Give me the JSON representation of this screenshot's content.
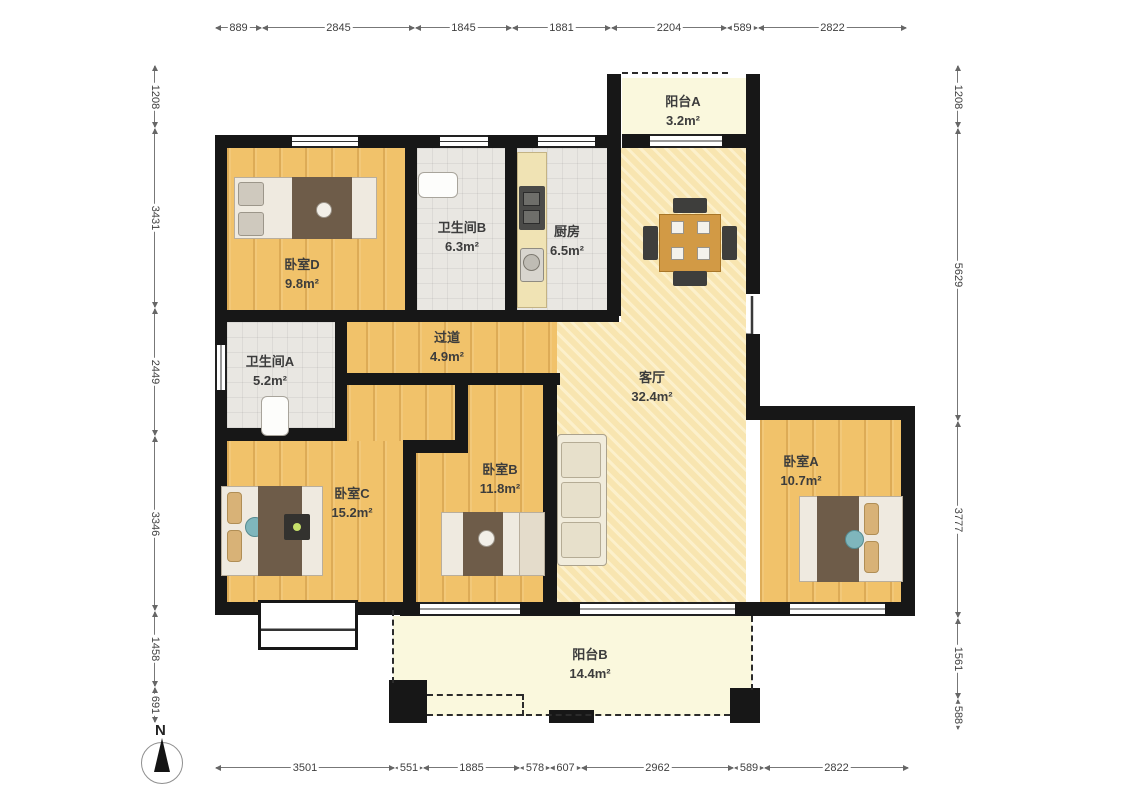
{
  "compass": {
    "label": "N"
  },
  "rooms": [
    {
      "id": "balcony-a",
      "name": "阳台A",
      "area": "3.2m²",
      "cx": 683,
      "cy": 92
    },
    {
      "id": "bedroom-d",
      "name": "卧室D",
      "area": "9.8m²",
      "cx": 302,
      "cy": 255
    },
    {
      "id": "bathroom-b",
      "name": "卫生间B",
      "area": "6.3m²",
      "cx": 462,
      "cy": 218
    },
    {
      "id": "kitchen",
      "name": "厨房",
      "area": "6.5m²",
      "cx": 567,
      "cy": 222
    },
    {
      "id": "hallway",
      "name": "过道",
      "area": "4.9m²",
      "cx": 447,
      "cy": 328
    },
    {
      "id": "bathroom-a",
      "name": "卫生间A",
      "area": "5.2m²",
      "cx": 270,
      "cy": 352
    },
    {
      "id": "living-room",
      "name": "客厅",
      "area": "32.4m²",
      "cx": 652,
      "cy": 368
    },
    {
      "id": "bedroom-a",
      "name": "卧室A",
      "area": "10.7m²",
      "cx": 801,
      "cy": 452
    },
    {
      "id": "bedroom-c",
      "name": "卧室C",
      "area": "15.2m²",
      "cx": 352,
      "cy": 484
    },
    {
      "id": "bedroom-b",
      "name": "卧室B",
      "area": "11.8m²",
      "cx": 500,
      "cy": 460
    },
    {
      "id": "balcony-b",
      "name": "阳台B",
      "area": "14.4m²",
      "cx": 590,
      "cy": 645
    }
  ],
  "dimensions": {
    "top": {
      "values": [
        "889",
        "2845",
        "1845",
        "1881",
        "2204",
        "589",
        "2822"
      ]
    },
    "bottom": {
      "values": [
        "3501",
        "551",
        "1885",
        "578",
        "607",
        "2962",
        "589",
        "2822"
      ]
    },
    "left": {
      "values": [
        "1208",
        "3431",
        "2449",
        "3346",
        "1458",
        "691"
      ]
    },
    "right": {
      "values": [
        "1208",
        "5629",
        "3777",
        "1561",
        "588"
      ]
    }
  },
  "colors": {
    "wall": "#171717",
    "wood_floor": "#F1C26A",
    "living_floor": "#F8E5B0",
    "tile_floor": "#E9E7E2",
    "balcony_floor": "#FAF8DD",
    "label_text": "#3c3c3c"
  }
}
